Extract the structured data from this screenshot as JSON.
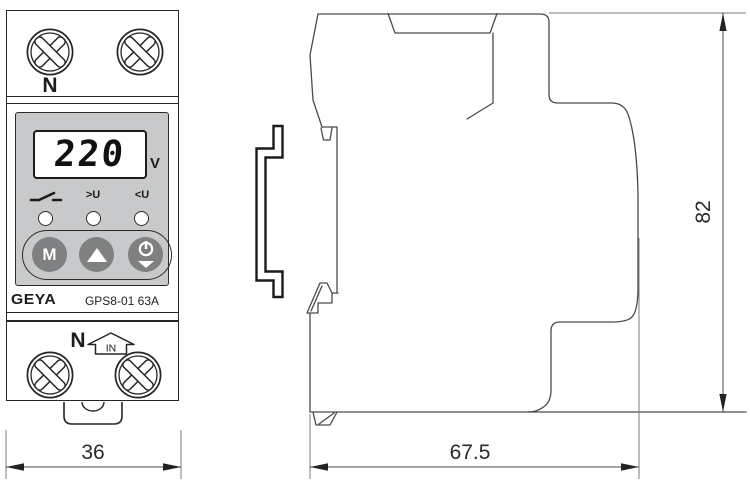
{
  "front_view": {
    "top_terminal": {
      "label": "N"
    },
    "lcd": {
      "value": "220",
      "unit": "V"
    },
    "indicators": [
      {
        "icon": "switch-contact-icon",
        "label": ""
      },
      {
        "label": ">U"
      },
      {
        "label": "<U"
      }
    ],
    "buttons": [
      {
        "label": "M"
      },
      {
        "icon": "up-triangle-icon"
      },
      {
        "icon": "power-restore-icon"
      }
    ],
    "brand": "GEYA",
    "model": "GPS8-01 63A",
    "bottom_terminal": {
      "label": "N",
      "input_badge": "IN"
    }
  },
  "dimensions": {
    "front_width": "36",
    "side_depth": "67.5",
    "side_height": "82"
  },
  "colors": {
    "panel_gray": "#c7c9ca",
    "button_gray": "#7e8082",
    "line_dark": "#262626",
    "line_side": "#4a4a4a"
  }
}
